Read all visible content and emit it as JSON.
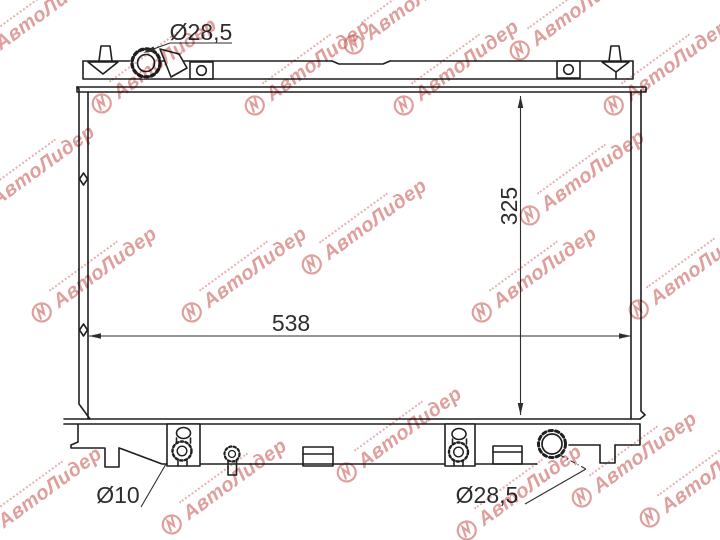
{
  "page": {
    "background": "#ffffff"
  },
  "drawing": {
    "line_color": "#1f1f1f",
    "dim_color": "#2e2e2e",
    "labels": {
      "filler_neck_diameter": "Ø28,5",
      "core_height": "325",
      "core_width": "538",
      "drain_plug_diameter": "Ø10",
      "outlet_pipe_diameter": "Ø28,5"
    }
  },
  "watermark": {
    "text": "АвтоЛидер",
    "color": "#c0403a",
    "positions": [
      [
        -18,
        52
      ],
      [
        352,
        42
      ],
      [
        518,
        48
      ],
      [
        100,
        101
      ],
      [
        253,
        103
      ],
      [
        402,
        103
      ],
      [
        612,
        103
      ],
      [
        -22,
        208
      ],
      [
        310,
        262
      ],
      [
        528,
        213
      ],
      [
        40,
        310
      ],
      [
        190,
        310
      ],
      [
        480,
        310
      ],
      [
        637,
        307
      ],
      [
        -15,
        530
      ],
      [
        345,
        470
      ],
      [
        580,
        495
      ],
      [
        170,
        522
      ],
      [
        465,
        528
      ],
      [
        648,
        515
      ]
    ]
  }
}
